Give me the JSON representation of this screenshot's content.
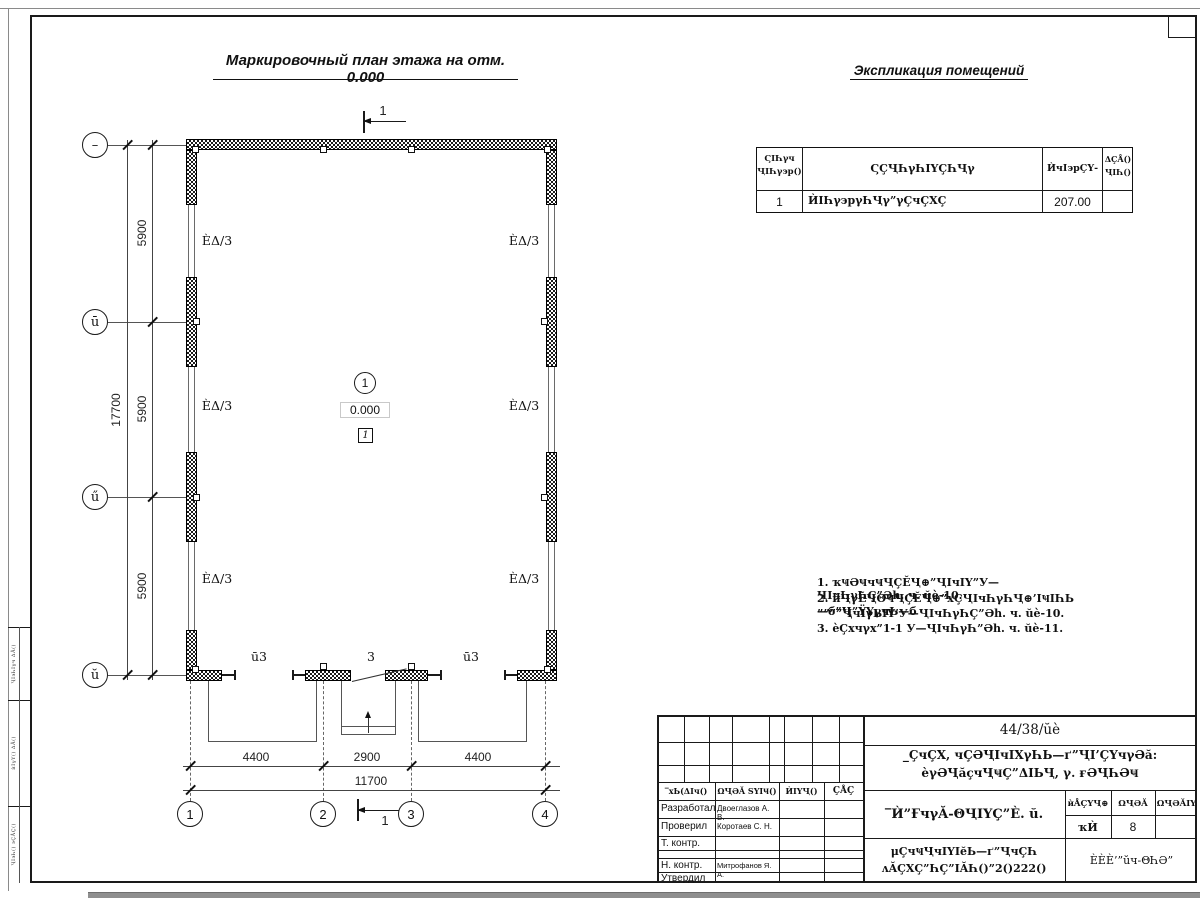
{
  "page": {
    "plan_title": "Маркировочный план этажа на отм. 0.000",
    "explication_title": "Экспликация помещений"
  },
  "explication": {
    "header": {
      "col1a": "ϚΙҺγч",
      "col1b": "ҶΙҺγ϶р()",
      "col2": "ϚÇҶҺγҺΙΥÇҺҶγ",
      "col3": "ЍчΙ϶рÇΥ-",
      "col4a": "ΔÇÅ()",
      "col4b": "ҶΙҺ()"
    },
    "row": {
      "num": "1",
      "name": "ЍΙҺγ϶рγҺҶγ”γÇчÇХÇ",
      "area": "207.00",
      "note": ""
    }
  },
  "grid": {
    "row1": "–",
    "row2": "ū",
    "row3": "ű",
    "row4": "ŭ",
    "col1": "1",
    "col2": "2",
    "col3": "3",
    "col4": "4"
  },
  "dims": {
    "v1": "5900",
    "v2": "5900",
    "v3": "5900",
    "vtotal": "17700",
    "h1": "4400",
    "h2": "2900",
    "h3": "4400",
    "htotal": "11700"
  },
  "plan": {
    "wall_label": "ÈΔ/3",
    "open_left": "ū3",
    "door": "3",
    "open_right": "ū3",
    "room_num": "1",
    "elevation": "0.000",
    "room_type": "1",
    "section": "1"
  },
  "notes": {
    "l1": "1. ҡҸӘҸчҸҶÇĔҶ⊕”ҶΙчΙΥ”У—ҶΙчҺγҺÇ”Әh. ч. ŭè-10.",
    "l2": "2. ѝҶγĔҶΘҸҶÇĔҶ⊕”хÇҶΙчҺγҺҶ⊕’ΙҸΙҺЬ—б”Ҷ”ΫΥγчЬ—б",
    "l3": "””””ҶчΙγЬΙΥ’У—ҶΙчҺγҺÇ”Әh. ч. ŭè-10.",
    "l4": "3. ѐÇхчγх”1-1 У—ҶΙчҺγҺ”Әh. ч. ŭè-11."
  },
  "stamp": {
    "chdr1": "‾хЬ(ΔΙч()",
    "chdr2": "ΩҶӘĂ ЅΥΙҸ()",
    "chdr3": "ЍΙΥҶ()",
    "chdr4": "ÇÅÇ",
    "r1": "Разработал",
    "n1": "Двоеглазов А. В.",
    "r2": "Проверил",
    "n2": "Коротаев С. Н.",
    "r3": "Т. контр.",
    "r4": "Н. контр.",
    "n4": "Митрофанов Я. А.",
    "r5": "Утвердил",
    "doc": "44/38/ŭè",
    "proj1": "_ÇчÇХ, чÇӘҶΙчΙХγҺЬ—ґ”ҶΙ’ÇΥчγӘă:",
    "proj2": "ѐγӘҶăҫчҶҸÇ”ΔΙЬҶ, γ. ғӘҶҺӘҸ",
    "sheet_title": "‾Ѝ”ҒчγĂ-ΘҶΙΥÇ”È. ŭ.",
    "stage_h": "ѝÅÇΥҶ⊕",
    "list_h": "ΩҶӘĂ",
    "lists_h": "ΩҶӘĂΙΥ",
    "stage": "ҡЍ",
    "list": "8",
    "lists": "",
    "org1": "μÇчҸҶчΙΥΙĕЬ—ґ”ҶчÇҺ",
    "org2": "ʌĂÇХÇ”ҺÇ”ΙĂҺ()”2()222()",
    "company": "ÈÈÈ’”ŭч-ΘҺӘ”"
  },
  "strip": {
    "t1": "ҶΙ϶ҺΙγч ΔÅ()",
    "t2": "ѝΙγΥ() ΔÅ()",
    "t3": "ҶΙ϶Һ() ϶ÇÅÇ()"
  }
}
